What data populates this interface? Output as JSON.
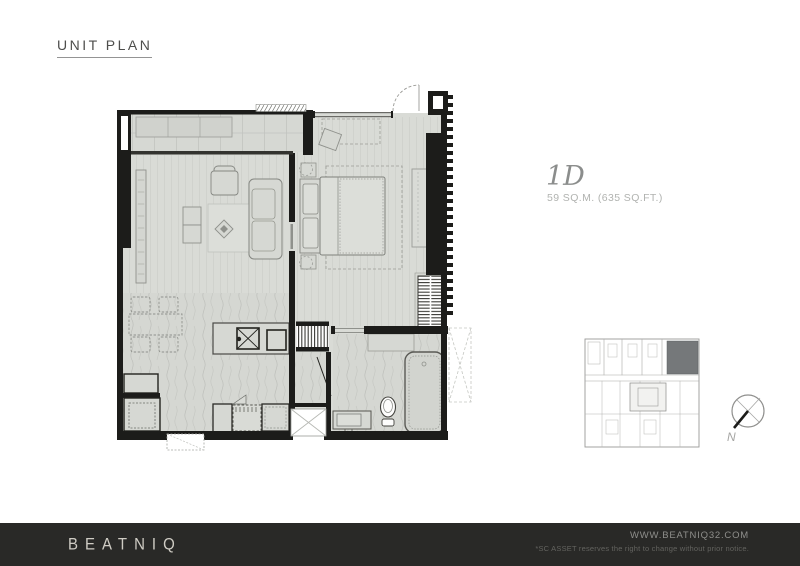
{
  "header": {
    "title": "UNIT PLAN"
  },
  "unit": {
    "name": "1D",
    "area": "59 SQ.M. (635 SQ.FT.)"
  },
  "compass": {
    "label": "N"
  },
  "footer": {
    "brand": "BEATNIQ",
    "website": "WWW.BEATNIQ32.COM",
    "disclaimer": "*SC ASSET reserves the right to change without prior notice."
  },
  "colors": {
    "background": "#ffffff",
    "wall": "#1c1c1a",
    "floor_fill": "#d9dbd6",
    "floor_texture": "#c0c2bd",
    "furniture_line": "#858782",
    "footer_bg": "#292927",
    "brand_text": "#cfccc4",
    "keyplan_highlight": "#75787a",
    "muted_text": "#b1b3b0"
  },
  "floorplan": {
    "rooms": [
      "balcony",
      "living-room",
      "bedroom",
      "dining-kitchen",
      "shower-room",
      "bathroom",
      "entrance-foyer"
    ],
    "fixtures": [
      "balcony-bench",
      "sofa",
      "armchair",
      "coffee-table",
      "dining-set",
      "bed",
      "wardrobe",
      "kitchen-sink",
      "cooktop",
      "refrigerator",
      "washer",
      "vanity",
      "toilet",
      "bathtub"
    ]
  }
}
